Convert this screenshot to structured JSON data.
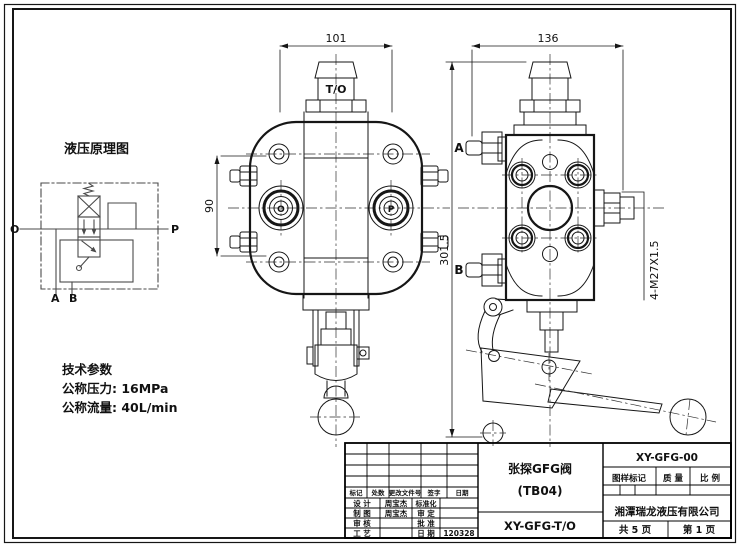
{
  "schematic": {
    "title": "液压原理图",
    "port_o": "O",
    "port_p": "P",
    "port_a": "A",
    "port_b": "B"
  },
  "tech": {
    "title": "技术参数",
    "pressure": "公称压力: 16MPa",
    "flow": "公称流量: 40L/min"
  },
  "front_view": {
    "dim_width": "101",
    "dim_height": "90",
    "top_port_label": "T/O",
    "port_left_label": "O",
    "port_right_label": "P"
  },
  "side_view": {
    "dim_width": "136",
    "dim_height": "301.5",
    "port_a_label": "A",
    "port_b_label": "B",
    "thread_note": "4-M27X1.5"
  },
  "title_block": {
    "product_name": "张探GFG阀",
    "product_model": "(TB04)",
    "drawing_code": "XY-GFG-T/O",
    "doc_number": "XY-GFG-00",
    "rev": {
      "mark": "标记",
      "count": "处数",
      "change_doc": "更改文件号",
      "sign": "签字",
      "date": "日期"
    },
    "staff": {
      "design_label": "设 计",
      "design_name": "周宝杰",
      "draft_label": "制 图",
      "draft_name": "周宝杰",
      "check_label": "审 核",
      "process_label": "工 艺",
      "standard_label": "标准化",
      "verify_label": "审 定",
      "approve_label": "批 准",
      "date_label": "日 期",
      "date_value": "120328"
    },
    "mark_label": "图样标记",
    "weight_label": "质 量",
    "scale_label": "比 例",
    "company": "湘潭瑞龙液压有限公司",
    "sheet_total": "共 5 页",
    "sheet_number": "第 1 页"
  }
}
